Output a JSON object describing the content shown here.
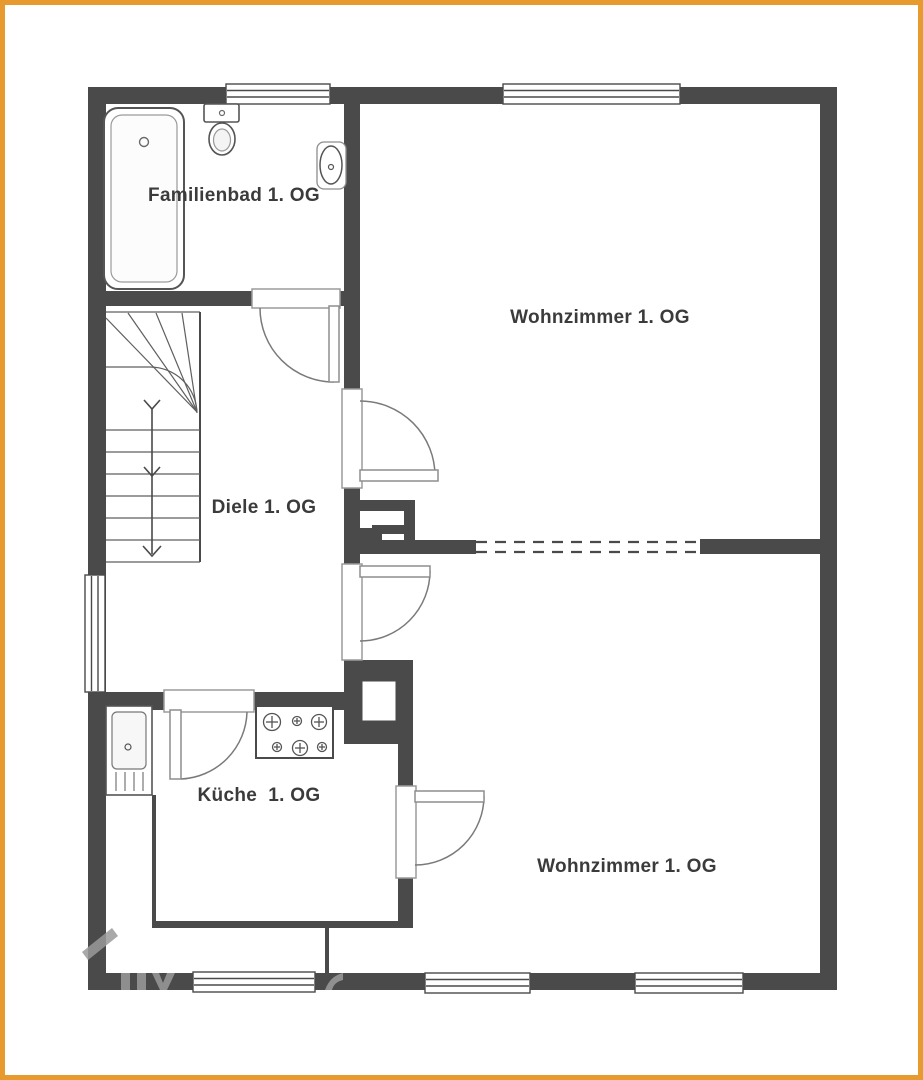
{
  "plan": {
    "type": "floor-plan",
    "floor_suffix": "1. OG",
    "rooms": [
      {
        "id": "familienbad",
        "label": "Familienbad 1. OG"
      },
      {
        "id": "wohnzimmer-oben",
        "label": "Wohnzimmer 1. OG"
      },
      {
        "id": "diele",
        "label": "Diele 1. OG"
      },
      {
        "id": "kueche",
        "label": "Küche  1. OG"
      },
      {
        "id": "wohnzimmer-unten",
        "label": "Wohnzimmer 1. OG"
      }
    ],
    "fixtures": [
      {
        "name": "bathtub-icon"
      },
      {
        "name": "toilet-icon"
      },
      {
        "name": "washbasin-icon"
      },
      {
        "name": "kitchen-sink-icon"
      },
      {
        "name": "stove-icon"
      },
      {
        "name": "staircase-icon"
      },
      {
        "name": "chimney-icon"
      }
    ],
    "colors": {
      "wall": "#4a4a4a",
      "page_border": "#E79A2D",
      "label_text": "#3b3b3b",
      "background": "#ffffff",
      "watermark": "#9b9b9b"
    }
  }
}
